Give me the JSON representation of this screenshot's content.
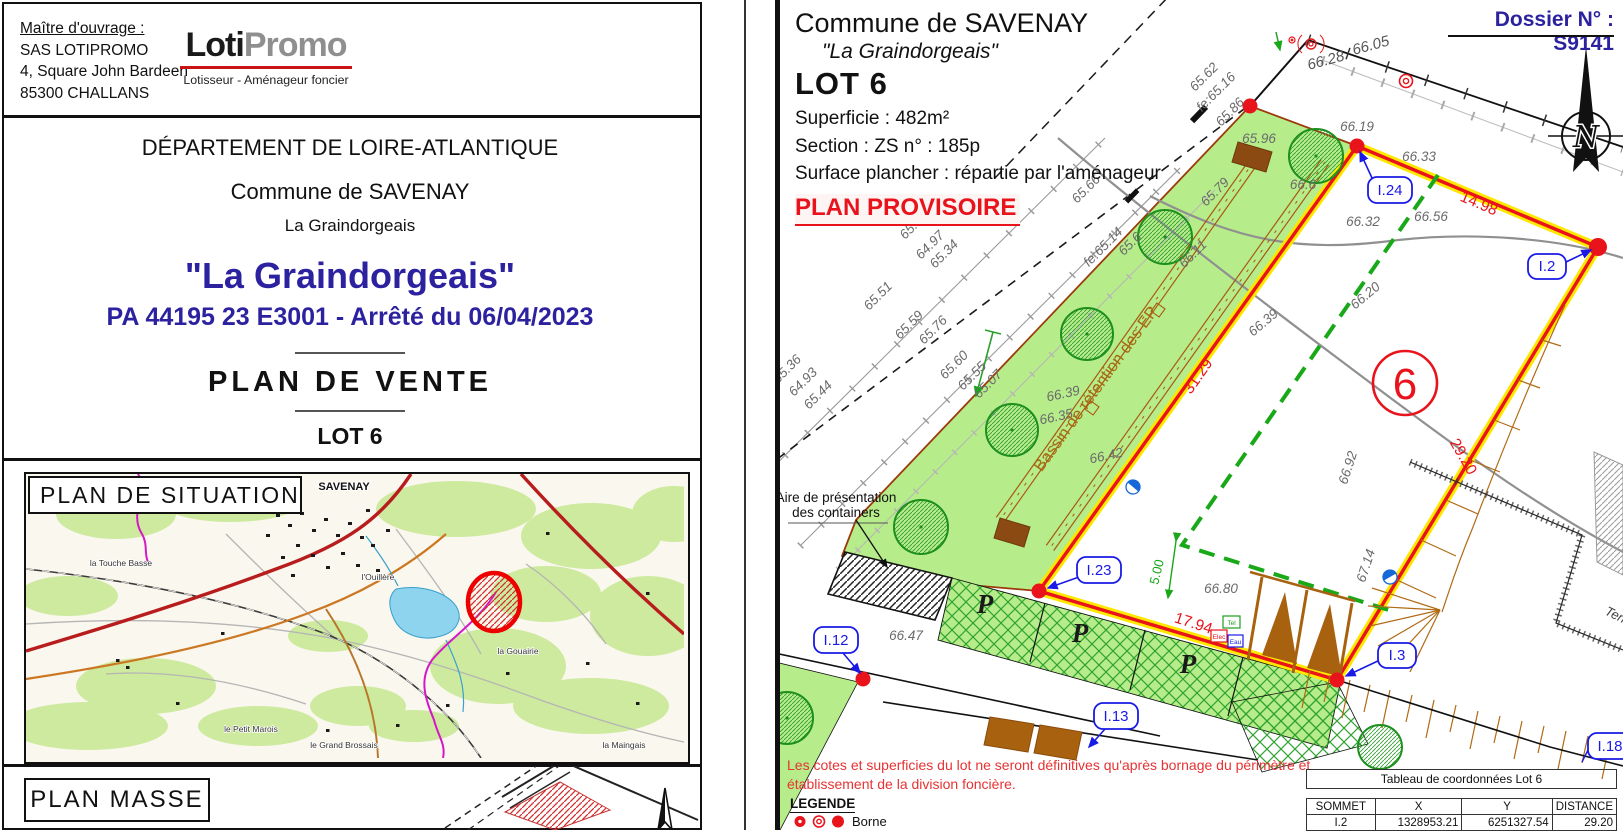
{
  "left": {
    "owner_label": "Maître d'ouvrage :",
    "owner1": "SAS LOTIPROMO",
    "owner2": "4, Square John Bardeen",
    "owner3": "85300 CHALLANS",
    "logo_a": "Loti",
    "logo_b": "Promo",
    "logo_tag": "Lotisseur - Aménageur foncier",
    "dept": "DÉPARTEMENT DE LOIRE-ATLANTIQUE",
    "commune": "Commune de SAVENAY",
    "place": "La Graindorgeais",
    "title": "\"La Graindorgeais\"",
    "permit": "PA 44195 23 E3001 - Arrêté du 06/04/2023",
    "doctype": "PLAN  DE  VENTE",
    "lot": "LOT 6",
    "situation": "PLAN  DE  SITUATION",
    "masse": "PLAN  MASSE",
    "map": {
      "town": "SAVENAY",
      "p1": "la Touche Basse",
      "p2": "l'Ouillère",
      "p3": "la Gouairie",
      "p4": "le Petit Marois",
      "p5": "le Grand Brossais",
      "p6": "la Maingais"
    }
  },
  "rp": {
    "commune": "Commune de SAVENAY",
    "place": "\"La Graindorgeais\"",
    "lot": "LOT 6",
    "superficie": "Superficie :  482m²",
    "section": "Section :  ZS      n° :  185p",
    "surface": "Surface plancher : répartie par l'aménageur",
    "provisoire": "PLAN PROVISOIRE",
    "dossier": "Dossier N° : S9141",
    "north": "N",
    "num": "6",
    "basin": "Bassin de rétention des EP",
    "aire1": "Aire de présentation",
    "aire2": "des containers",
    "p": "P",
    "terr": "Terr",
    "tel": "Tel",
    "elec": "Elec",
    "eau": "Eau",
    "note1": "Les cotes et superficies du lot ne seront définitives qu'après bornage du périmètre et",
    "note2": "établissement de la division foncière.",
    "legende": "LEGENDE",
    "borne": "Borne",
    "v24": "I.24",
    "v2": "I.2",
    "v3": "I.3",
    "v23": "I.23",
    "v12": "I.12",
    "v13": "I.13",
    "v18": "I.18",
    "d1": "14.98",
    "d2": "29.20",
    "d3": "17.94",
    "d4": "31.29",
    "d5": "5.00",
    "r1": "66.28",
    "r2": "66.05",
    "spots": [
      "65.36",
      "64.93",
      "65.44",
      "65.51",
      "65.59",
      "65.76",
      "65.39",
      "64.97",
      "65.34",
      "65.60",
      "65.55",
      "65.07",
      "65.66",
      "fe:65.14",
      "65.6",
      "66.11",
      "65.62",
      "fe:65.16",
      "65.86",
      "65.79",
      "65.96",
      "66.19",
      "66.6",
      "66.39",
      "66.35",
      "66.42",
      "66.33",
      "66.32",
      "66.56",
      "66.20",
      "66.39",
      "66.92",
      "67.14",
      "66.47",
      "66.80"
    ],
    "table": {
      "title": "Tableau de coordonnées Lot 6",
      "h1": "SOMMET",
      "h2": "X",
      "h3": "Y",
      "h4": "DISTANCE",
      "r1c1": "I.2",
      "r1c2": "1328953.21",
      "r1c3": "6251327.54",
      "r1c4": "29.20"
    }
  },
  "colors": {
    "navy": "#2c22a0",
    "red": "#e8131b",
    "lot_yellow": "#ffe800",
    "green_fill": "#b7ec8b",
    "label_blue": "#1a1ae6",
    "brown": "#a8620f"
  }
}
